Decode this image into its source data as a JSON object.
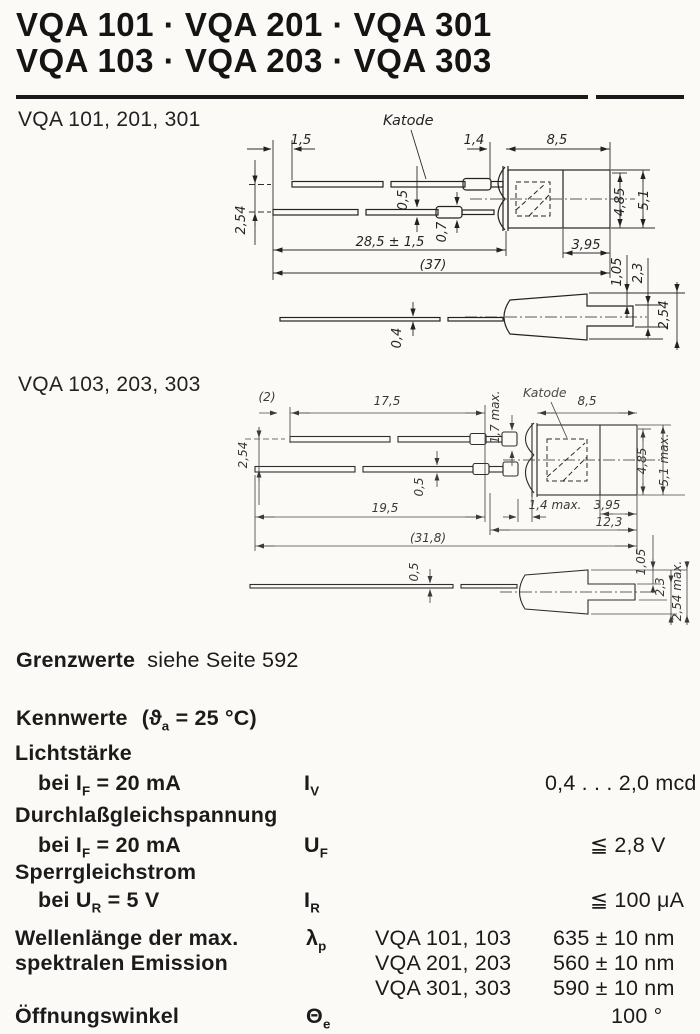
{
  "header": {
    "line1": "VQA 101 · VQA 201 · VQA 301",
    "line2": "VQA 103 · VQA 203 · VQA 303"
  },
  "drawing1": {
    "label": "VQA 101, 201, 301",
    "katode": "Katode",
    "dims": {
      "lead_offset": "1,5",
      "dome": "1,4",
      "body_len": "8,5",
      "lead_thick_a": "0,5",
      "lead_thick_b": "0,7",
      "lead_len": "28,5 ± 1,5",
      "total_len": "(37)",
      "lead_pitch": "2,54",
      "body_h_inner": "4,85",
      "body_h_outer": "5,1",
      "cap_len": "3,95",
      "rim_a": "1,05",
      "rim_b": "2,3",
      "lead_side_thick": "0,4",
      "rim_c": "2,54"
    }
  },
  "drawing2": {
    "label": "VQA 103, 203, 303",
    "katode": "Katode",
    "dims": {
      "lead_offset": "(2)",
      "upper_lead_len": "17,5",
      "crimp_h": "1,7 max.",
      "body_len": "8,5",
      "lead_pitch": "2,54",
      "lead_thick": "0,5",
      "lower_lead_len": "19,5",
      "dome": "1,4 max.",
      "cap_len": "3,95",
      "front_len": "12,3",
      "total_len": "(31,8)",
      "body_h_inner": "4,85",
      "body_h_outer": "5,1 max.",
      "lead_side_thick": "0,5",
      "rim_a": "1,05",
      "rim_b": "2,3",
      "rim_c": "2,54 max."
    }
  },
  "limits": {
    "heading": "Grenzwerte",
    "rest": "siehe Seite 592"
  },
  "characteristics": {
    "heading": "Kennwerte",
    "cond_pre": "(ϑ",
    "cond_sub": "a",
    "cond_post": " = 25 °C)",
    "rows": {
      "lichtstaerke": {
        "param": "Lichtstärke",
        "cond_pre": "bei I",
        "cond_sub": "F",
        "cond_post": " = 20 mA",
        "sym": "I",
        "sym_sub": "V",
        "value": "0,4 . . . 2,0 mcd"
      },
      "durchlass": {
        "param": "Durchlaßgleichspannung",
        "cond_pre": "bei I",
        "cond_sub": "F",
        "cond_post": " = 20 mA",
        "sym": "U",
        "sym_sub": "F",
        "value": "≦ 2,8 V"
      },
      "sperr": {
        "param": "Sperrgleichstrom",
        "cond_pre": "bei U",
        "cond_sub": "R",
        "cond_post": " = 5 V",
        "sym": "I",
        "sym_sub": "R",
        "value": "≦ 100 μA"
      },
      "wellenlaenge": {
        "param_line1": "Wellenlänge der max.",
        "param_line2": "spektralen Emission",
        "sym": "λ",
        "sym_sub": "p",
        "variants": [
          {
            "types": "VQA 101, 103",
            "value": "635 ± 10 nm"
          },
          {
            "types": "VQA 201, 203",
            "value": "560 ± 10 nm"
          },
          {
            "types": "VQA 301, 303",
            "value": "590 ± 10 nm"
          }
        ]
      },
      "oeffnungswinkel": {
        "param": "Öffnungswinkel",
        "sym": "Θ",
        "sym_sub": "e",
        "value": "100 °"
      }
    }
  }
}
